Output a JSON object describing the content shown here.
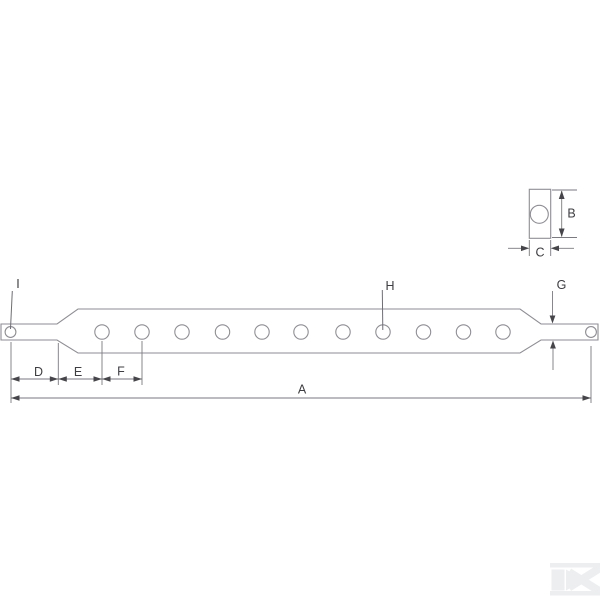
{
  "diagram": {
    "description": "Technical line drawing of a linkage drawbar: long flat bar with 11 holes, tapered ends with pin stubs (each with a small hole), a cross-section detail at top right, and dimension labels",
    "hole_count_main_bar": 11,
    "labels": {
      "A": "A",
      "B": "B",
      "C": "C",
      "D": "D",
      "E": "E",
      "F": "F",
      "G": "G",
      "H": "H",
      "I": "I"
    },
    "label_roles": {
      "A": "overall length",
      "B": "cross-section height",
      "C": "cross-section width",
      "D": "pin end to bar tip",
      "E": "bar tip to first hole",
      "F": "hole pitch",
      "G": "pin thickness",
      "H": "bar hole",
      "I": "pin hole"
    },
    "colors": {
      "outline": "#8e8e94",
      "dimension": "#7a7a80",
      "arrow": "#46464a",
      "text": "#3e3e42",
      "watermark": "#edeef0",
      "background": "#ffffff"
    },
    "icons": {
      "watermark": "k-logo"
    },
    "watermark_letter": "K"
  }
}
